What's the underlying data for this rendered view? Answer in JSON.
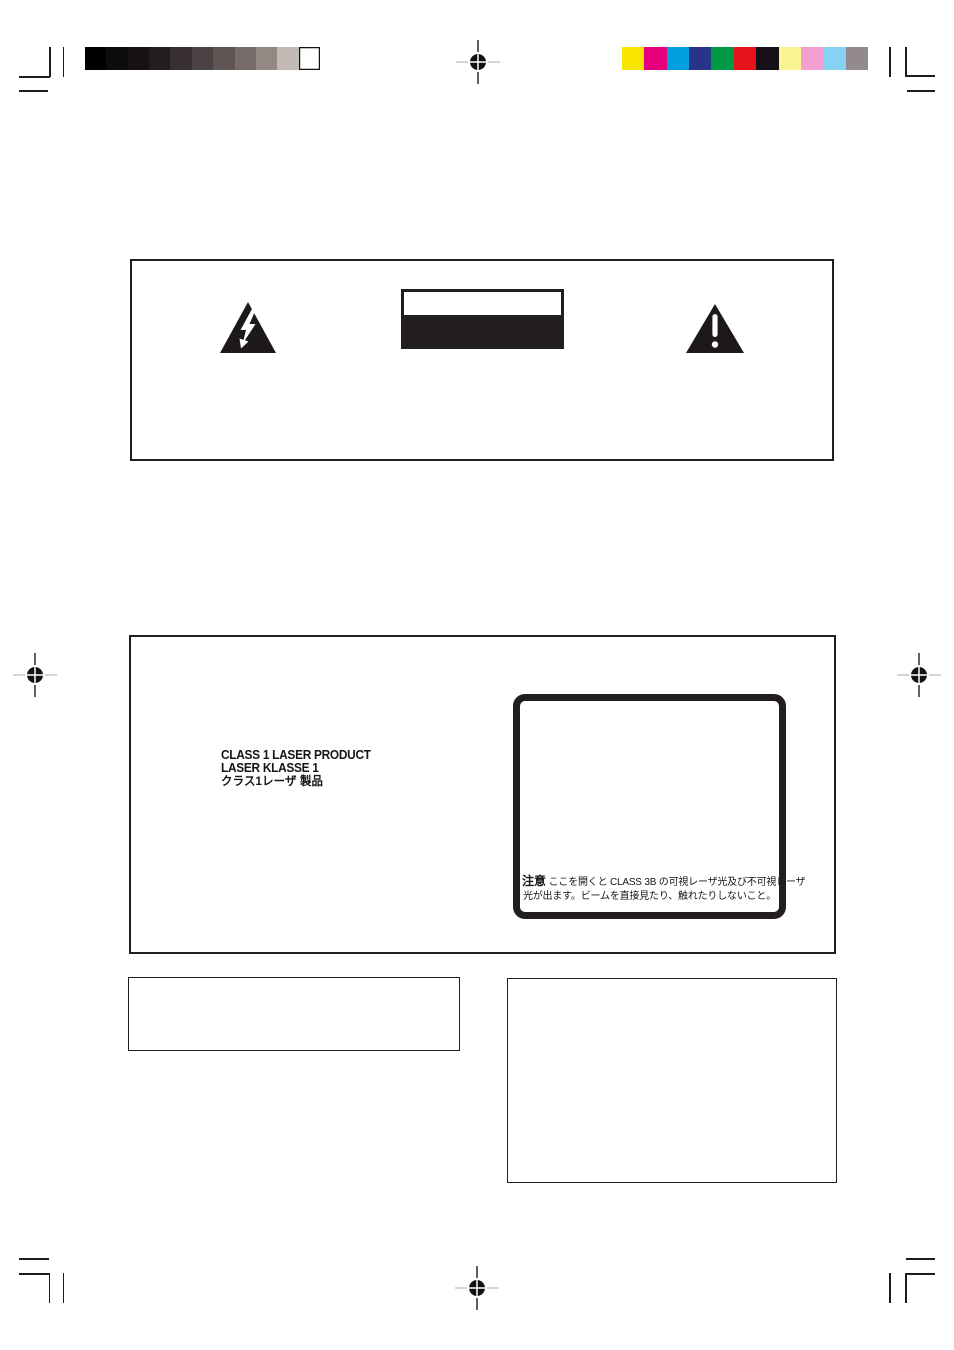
{
  "calibration": {
    "grayscale_patches": [
      "#000000",
      "#0d0b0c",
      "#161113",
      "#231d1e",
      "#372f30",
      "#4c4243",
      "#5f5554",
      "#776c6a",
      "#938884",
      "#c3bab6",
      "#ffffff"
    ],
    "color_patches": [
      "#f7e400",
      "#e6007e",
      "#00a0e0",
      "#28348a",
      "#009a44",
      "#e7131a",
      "#151015",
      "#faf391",
      "#f29fd2",
      "#85d2f2",
      "#928a8c"
    ]
  },
  "icons": {
    "registration_mark": "registration-target",
    "lightning": "lightning-bolt-in-triangle",
    "alert": "exclamation-in-triangle"
  },
  "laser_panel": {
    "class_label_lines": [
      "CLASS 1 LASER PRODUCT",
      "LASER KLASSE 1",
      "クラス1レーザ 製品"
    ],
    "caution": {
      "heading": "注意",
      "line1": "ここを開くと CLASS 3B の可視レーザ光及び不可視レーザ",
      "line2": "光が出ます。ビームを直接見たり、触れたりしないこと。"
    }
  },
  "colors": {
    "print_black": "#221e1f",
    "crosshair_light": "#c9c9c9"
  }
}
